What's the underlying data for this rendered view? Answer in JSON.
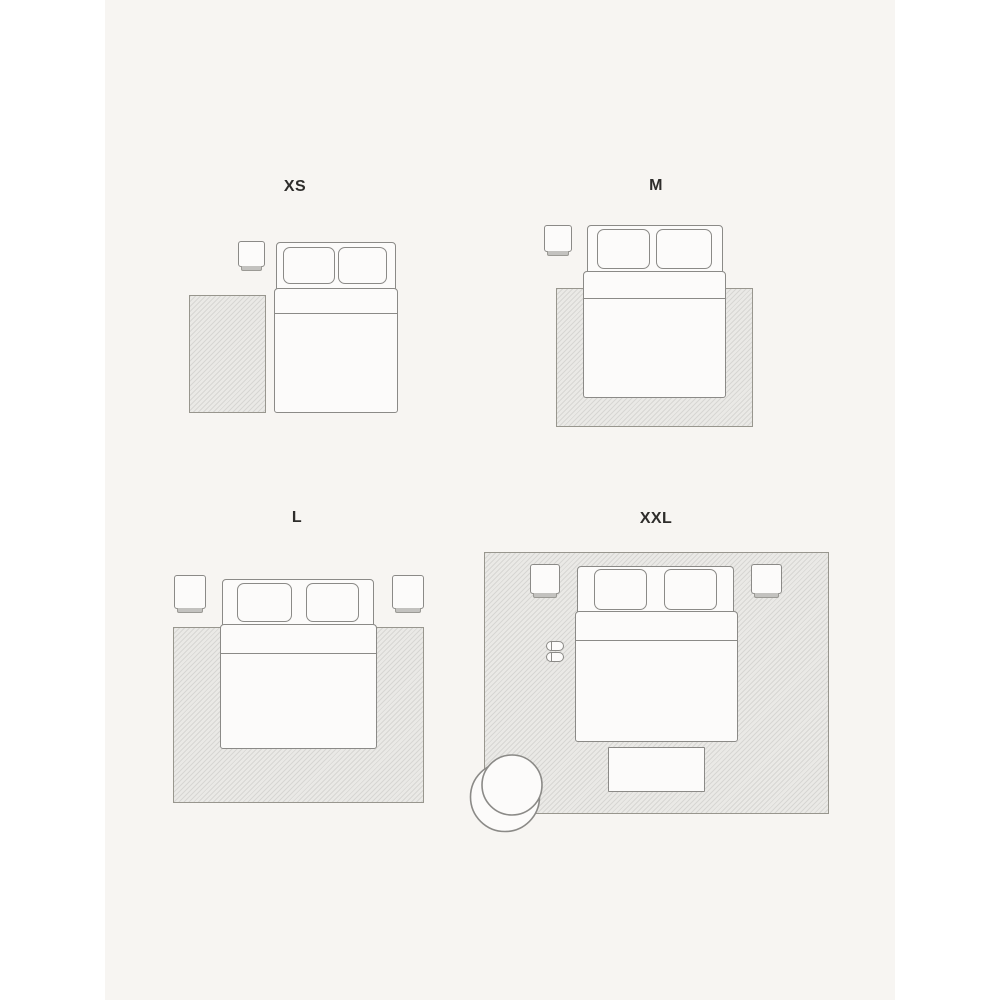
{
  "illustration": {
    "type": "rug-size-guide-bedroom-layouts",
    "background": "#ffffff",
    "panel_background": "#f7f5f2",
    "colors": {
      "outline": "#8b8a87",
      "rug_fill": "#eae9e6",
      "rug_border": "#98968e",
      "furniture_fill": "#fcfbfa",
      "nightstand_base": "#c3c2bf",
      "label_text": "#2e2d2b"
    },
    "sizes": [
      {
        "id": "xs",
        "label": "XS",
        "items": [
          "nightstand",
          "double-bed",
          "bedside-runner-rug"
        ]
      },
      {
        "id": "m",
        "label": "M",
        "items": [
          "nightstand",
          "double-bed",
          "rug-under-foot-of-bed"
        ]
      },
      {
        "id": "l",
        "label": "L",
        "items": [
          "nightstand-left",
          "nightstand-right",
          "double-bed",
          "rug-under-lower-two-thirds-of-bed"
        ]
      },
      {
        "id": "xxl",
        "label": "XXL",
        "items": [
          "full-room-rug",
          "nightstand-left",
          "nightstand-right",
          "double-bed",
          "slippers",
          "foot-bench",
          "round-armchair"
        ]
      }
    ]
  }
}
